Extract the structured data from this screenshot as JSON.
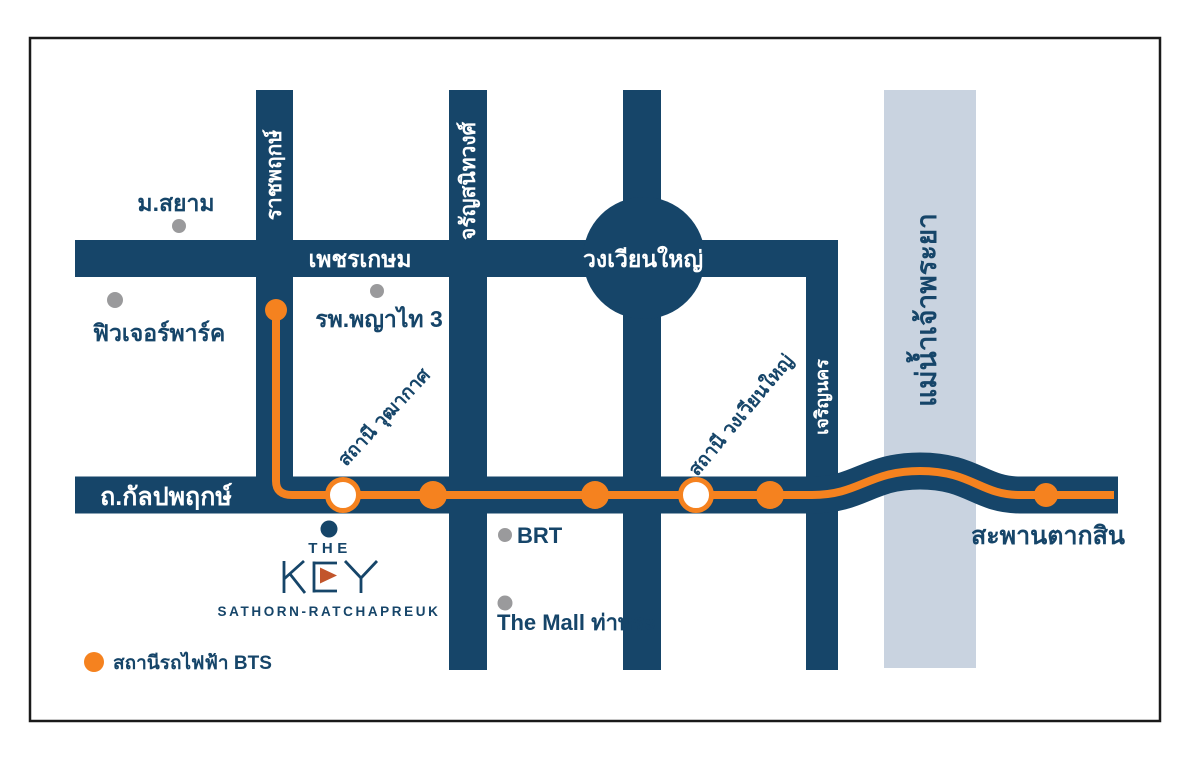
{
  "colors": {
    "road_navy": "#164569",
    "bts_orange": "#f5821f",
    "river_blue": "#c9d3e0",
    "landmark_gray": "#9a9a9c",
    "logo_accent_rust": "#c2552b",
    "frame_border": "#1a1a1a"
  },
  "roads": {
    "phetkasem": {
      "label": "เพชรเกษม"
    },
    "ratchaphruek": {
      "label": "ราชพฤกษ์"
    },
    "charansanitwong": {
      "label": "จรัญสนิทวงศ์"
    },
    "charoen_nakhon": {
      "label": "เจริญนคร"
    },
    "kalpapruek": {
      "label": "ถ.กัลปพฤกษ์"
    },
    "wongwian_yai_roundabout": {
      "label": "วงเวียนใหญ่"
    }
  },
  "river": {
    "label": "แม่น้ำเจ้าพระยา"
  },
  "bridge": {
    "label": "สะพานตากสิน"
  },
  "stations": {
    "wutthakat": {
      "label": "สถานี วุฒากาศ",
      "marker": "white-ring"
    },
    "wongwian_yai": {
      "label": "สถานี วงเวียนใหญ่",
      "marker": "white-ring"
    }
  },
  "landmarks": {
    "siam_university": {
      "label": "ม.สยาม"
    },
    "future_park": {
      "label": "ฟิวเจอร์พาร์ค"
    },
    "phyathai3_hospital": {
      "label": "รพ.พญาไท 3"
    },
    "brt": {
      "label": "BRT"
    },
    "the_mall_thapra": {
      "label": "The Mall ท่าพระ"
    }
  },
  "logo": {
    "the": "THE",
    "key": "KEY",
    "subtitle": "SATHORN-RATCHAPREUK"
  },
  "legend": {
    "bts_station": "สถานีรถไฟฟ้า BTS"
  }
}
